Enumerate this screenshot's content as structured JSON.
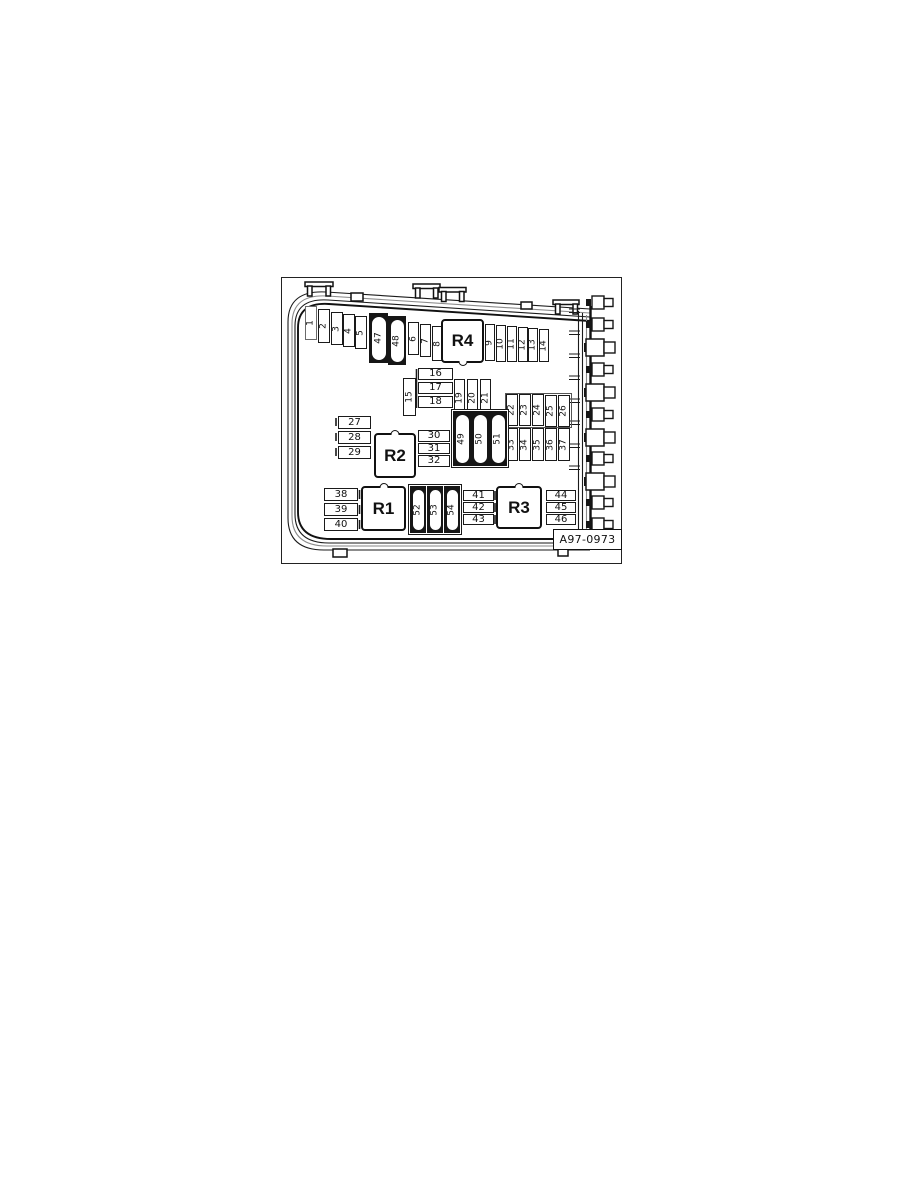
{
  "diagram": {
    "code": "A97-0973",
    "line_color": "#1a1a1a",
    "background_color": "#ffffff",
    "relays": {
      "r1": "R1",
      "r2": "R2",
      "r3": "R3",
      "r4": "R4"
    },
    "fuses": {
      "top": [
        "1",
        "2",
        "3",
        "4",
        "5",
        "6",
        "7",
        "8",
        "9",
        "10",
        "11",
        "12",
        "13",
        "14"
      ],
      "f15": "15",
      "stack_16_18": [
        "16",
        "17",
        "18"
      ],
      "col_19_21": [
        "19",
        "20",
        "21"
      ],
      "row_22_26": [
        "22",
        "23",
        "24",
        "25",
        "26"
      ],
      "stack_27_29": [
        "27",
        "28",
        "29"
      ],
      "stack_30_32": [
        "30",
        "31",
        "32"
      ],
      "row_33_37": [
        "33",
        "34",
        "35",
        "36",
        "37"
      ],
      "stack_38_40": [
        "38",
        "39",
        "40"
      ],
      "stack_41_43": [
        "41",
        "42",
        "43"
      ],
      "stack_44_46": [
        "44",
        "45",
        "46"
      ],
      "maxi_47_48": [
        "47",
        "48"
      ],
      "maxi_49_51": [
        "49",
        "50",
        "51"
      ],
      "maxi_52_54": [
        "52",
        "53",
        "54"
      ]
    }
  }
}
